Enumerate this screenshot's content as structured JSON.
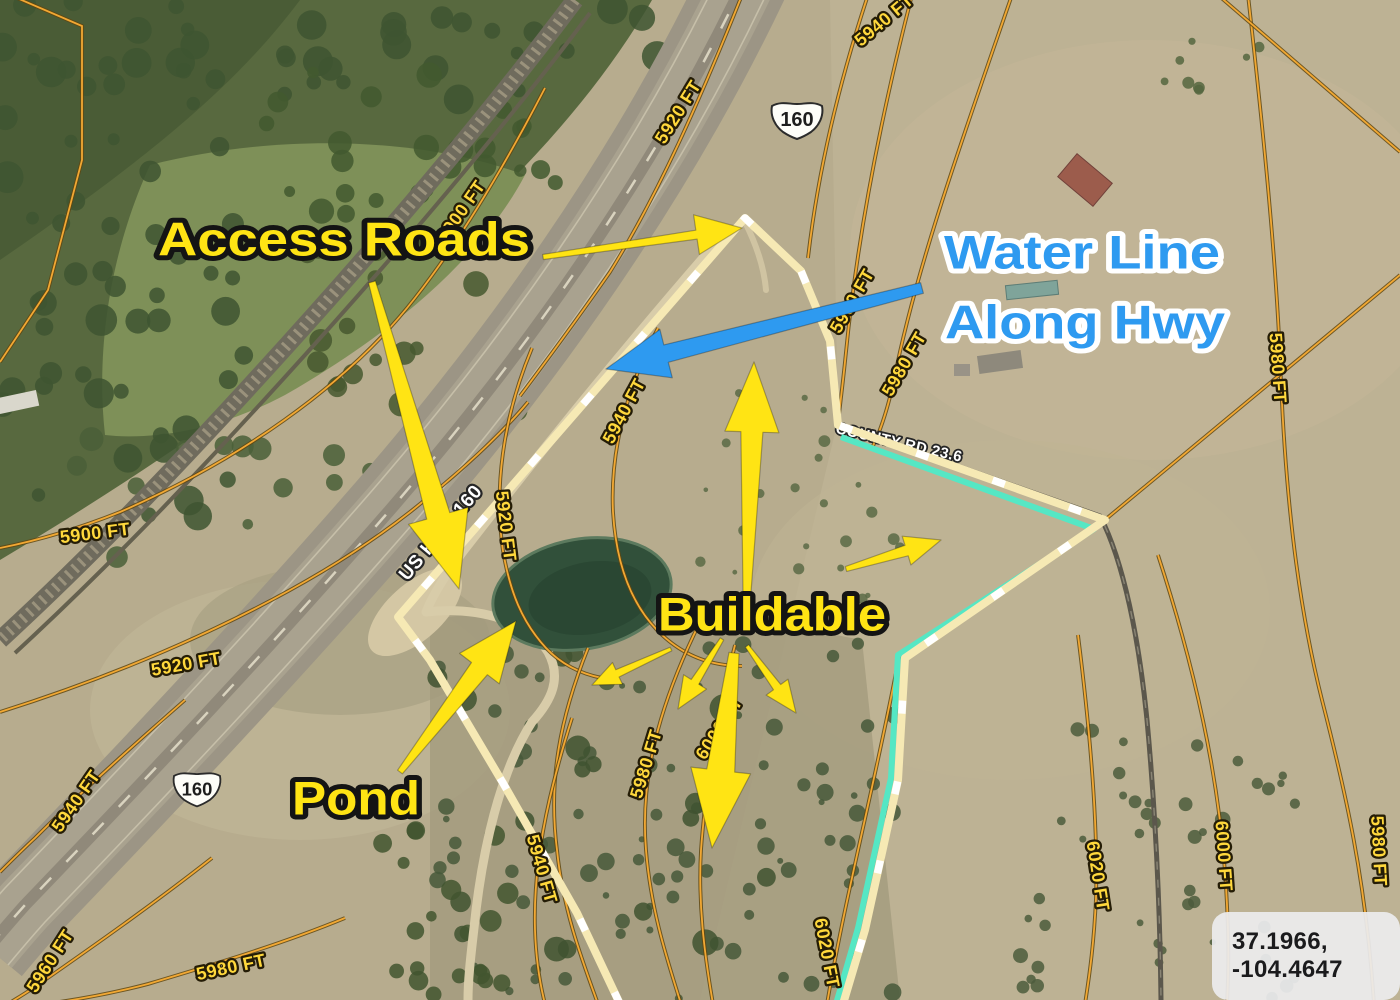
{
  "map": {
    "coordinates_badge": "37.1966, -104.4647",
    "highway_shields": [
      {
        "route": "160"
      },
      {
        "route": "160"
      }
    ],
    "road_labels": [
      {
        "text": "US HWY 160"
      },
      {
        "text": "COUNTY RD 23.6"
      }
    ],
    "contour_labels": [
      {
        "text": "5920 FT"
      },
      {
        "text": "5940 FT"
      },
      {
        "text": "900 FT"
      },
      {
        "text": "5900 FT"
      },
      {
        "text": "5920 FT"
      },
      {
        "text": "5940 FT"
      },
      {
        "text": "5960 FT"
      },
      {
        "text": "5980 FT"
      },
      {
        "text": "5920 FT"
      },
      {
        "text": "5940 FT"
      },
      {
        "text": "5960 FT"
      },
      {
        "text": "5980 FT"
      },
      {
        "text": "5980 FT"
      },
      {
        "text": "5980 FT"
      },
      {
        "text": "6000 FT"
      },
      {
        "text": "5940 FT"
      },
      {
        "text": "6020 FT"
      },
      {
        "text": "6020 FT"
      },
      {
        "text": "6000 FT"
      },
      {
        "text": "5980 FT"
      }
    ]
  },
  "annotations": {
    "access_roads": "Access Roads",
    "water_line_line1": "Water Line",
    "water_line_line2": "Along Hwy",
    "buildable": "Buildable",
    "pond": "Pond"
  },
  "colors": {
    "annotation_yellow": "#FFE414",
    "annotation_blue": "#2E9AF0",
    "boundary_cream": "#F6E9B4",
    "boundary_teal": "#55E7C4",
    "contour_orange": "#F2A833",
    "contour_label_yellow": "#FFD83C"
  }
}
